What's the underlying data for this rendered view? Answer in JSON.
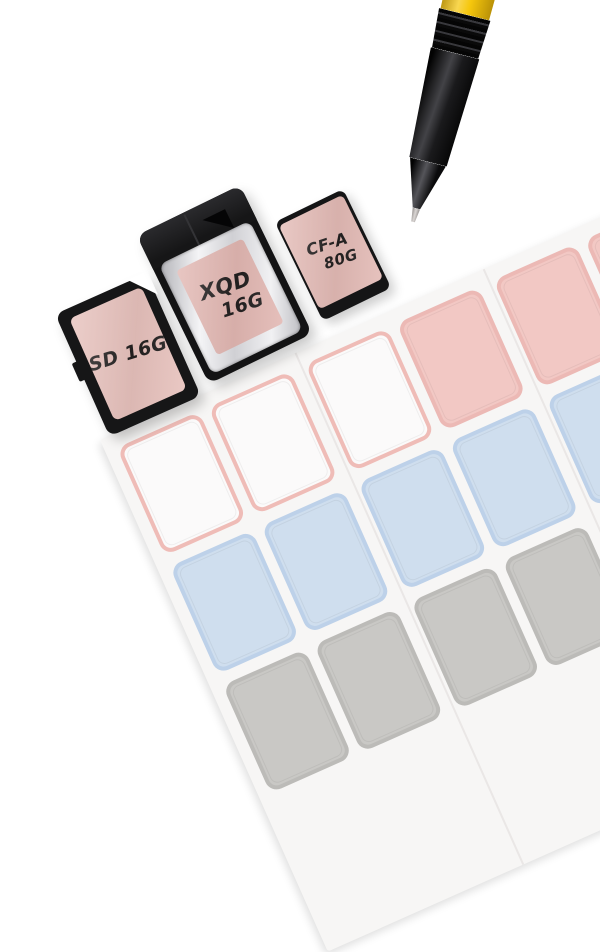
{
  "scene": {
    "background_color": "#ffffff",
    "objects": [
      "sticker-sheet",
      "sd-card",
      "xqd-card",
      "cfa-card",
      "pen"
    ]
  },
  "memory_cards": [
    {
      "type": "SD",
      "label_text": "SD 16G",
      "label_color": "#e7c1bc",
      "body_color": "#161617"
    },
    {
      "type": "XQD",
      "label_lines": [
        "XQD",
        "16G"
      ],
      "label_color": "#e2b7b2",
      "body_color": "#131314",
      "frame_color": "#e0e0e4"
    },
    {
      "type": "CF-A",
      "label_lines": [
        "CF-A",
        "80G"
      ],
      "label_color": "#e3bab5",
      "body_color": "#151516"
    }
  ],
  "pen": {
    "barrel_color": "#f6c70c",
    "grip_color": "#1a1a1c",
    "tip_color": "#c9c5c3"
  },
  "sticker_sheet": {
    "paper_color": "#f7f6f5",
    "palette": {
      "white": {
        "fill": "#fbfafa",
        "border": "#efbcb7"
      },
      "pink": {
        "fill": "#f2c8c4",
        "border": "#ecb9b5"
      },
      "blue": {
        "fill": "#cfdeee",
        "border": "#bdd1e9"
      },
      "gray": {
        "fill": "#c9c8c5",
        "border": "#bcbbb8"
      }
    },
    "grid": [
      [
        "white",
        "white",
        "white",
        "pink",
        "pink",
        "pink"
      ],
      [
        "blue",
        "blue",
        "blue",
        "blue",
        "blue",
        "blue"
      ],
      [
        "gray",
        "gray",
        "gray",
        "gray",
        "gray",
        "gray"
      ]
    ]
  }
}
